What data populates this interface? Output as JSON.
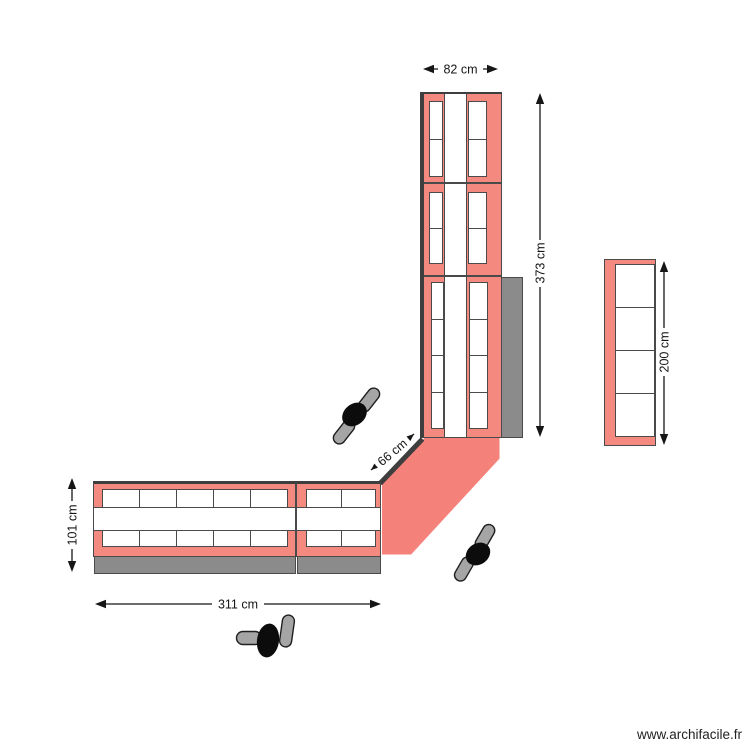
{
  "watermark": "www.archifacile.fr",
  "dimensions": {
    "column_width": "82 cm",
    "column_height": "373 cm",
    "shelf_height": "200 cm",
    "corner_front": "66 cm",
    "run_depth": "101 cm",
    "run_length": "311 cm"
  },
  "colors": {
    "bg": "#ffffff",
    "unit_fill": "#f4897f",
    "corner_fill": "#f5827a",
    "shadow_fill": "#8b8b8b",
    "wall_color": "#3e3e3e",
    "outline_color": "#4a4a4a",
    "dim_color": "#161616",
    "person_body": "#0c0c0c",
    "person_feet": "#a5a5a5",
    "watermark_color": "#222222"
  }
}
